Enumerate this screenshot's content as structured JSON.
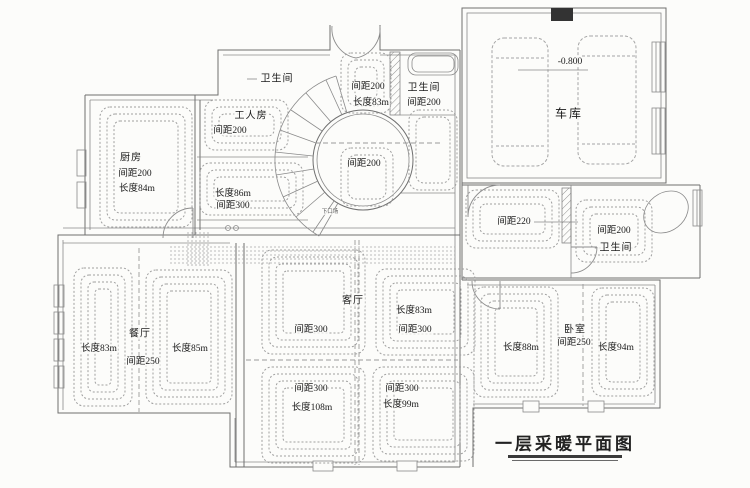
{
  "drawing": {
    "title": "一层采暖平面图",
    "rooms": {
      "kitchen": {
        "name": "厨房",
        "spacing": "间距200",
        "length": "长度84m"
      },
      "small_bath": {
        "name": "卫生间"
      },
      "worker_room": {
        "name": "工人房",
        "spacing": "间距200"
      },
      "hallway": {
        "length": "长度86m",
        "spacing": "间距300"
      },
      "vestibule": {
        "spacing": "间距200",
        "length": "长度83m"
      },
      "top_bath": {
        "name": "卫生间",
        "spacing": "间距200"
      },
      "stair_hall": {
        "spacing": "间距200",
        "note": "下口场"
      },
      "garage": {
        "name": "车库",
        "elevation": "-0.800"
      },
      "corridor": {
        "spacing": "间距220"
      },
      "right_bath": {
        "spacing": "间距200",
        "name": "卫生间"
      },
      "living": {
        "name": "客厅",
        "tl_spacing": "间距300",
        "tr_length": "长度83m",
        "tr_spacing": "间距300",
        "bl_spacing": "间距300",
        "bl_length": "长度108m",
        "br_spacing": "间距300",
        "br_length": "长度99m"
      },
      "dining": {
        "name": "餐厅",
        "left_length": "长度83m",
        "spacing": "间距250",
        "right_length": "长度85m"
      },
      "bedroom": {
        "name": "卧室",
        "spacing": "间距250",
        "left_length": "长度88m",
        "right_length": "长度94m"
      }
    },
    "colors": {
      "wall": "#6f6f6f",
      "coil": "#9f9f9f",
      "text": "#1b1b1b",
      "paper": "#fcfcfa",
      "column_block": "#333333"
    }
  }
}
